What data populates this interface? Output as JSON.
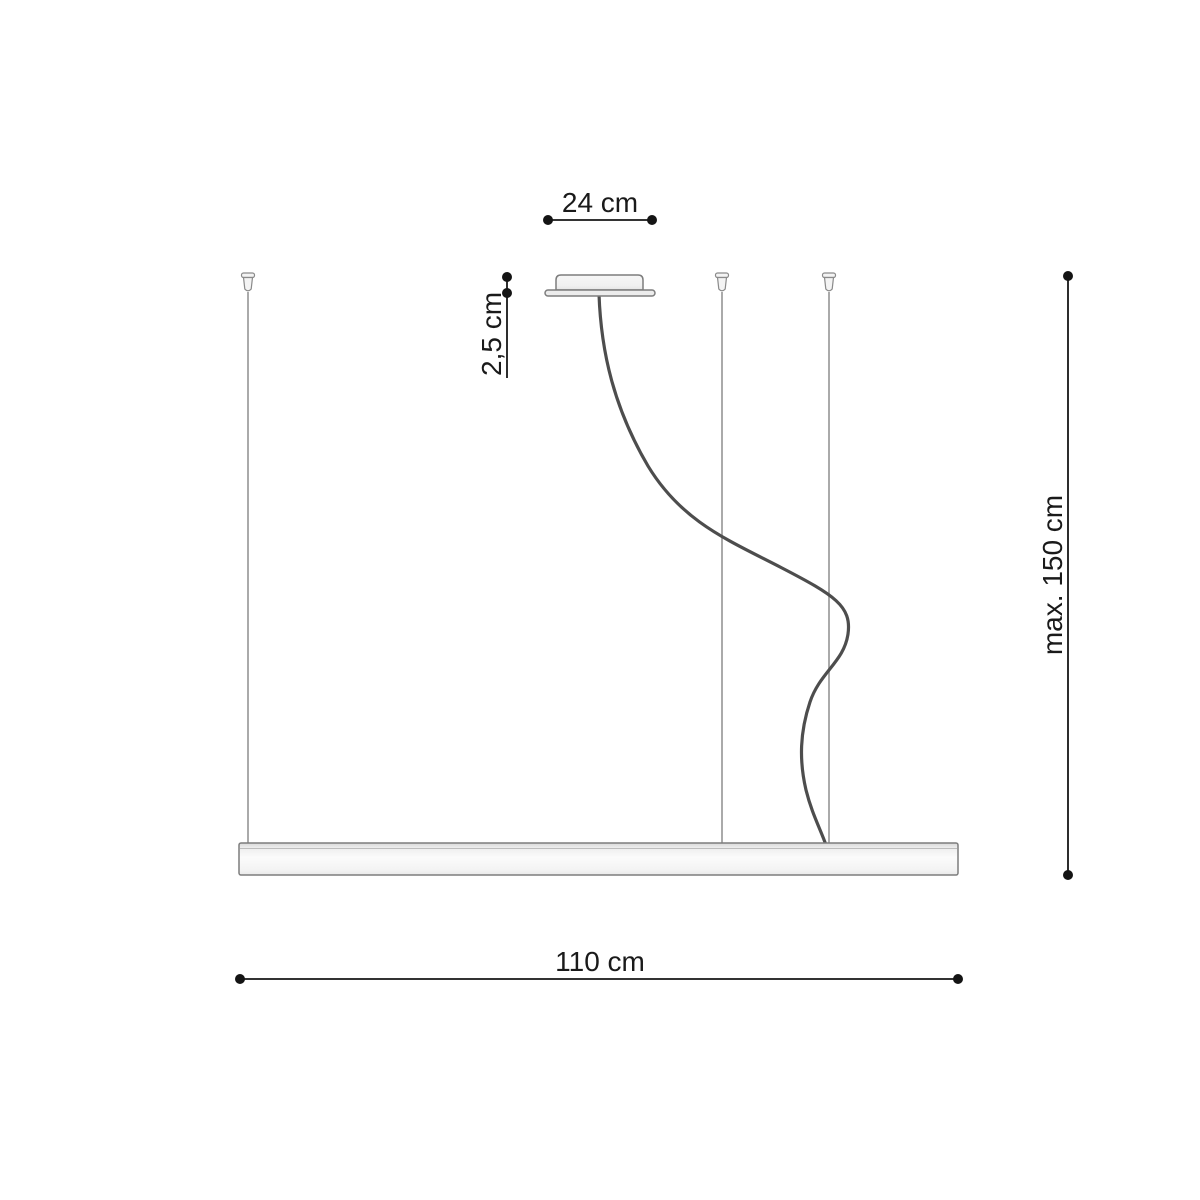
{
  "diagram": {
    "kind": "pendant-lamp-dimension-diagram",
    "dimensions": {
      "canopy_width": {
        "label": "24 cm"
      },
      "canopy_height": {
        "label": "2,5 cm"
      },
      "suspension_max": {
        "label": "max. 150 cm"
      },
      "bar_length": {
        "label": "110 cm"
      }
    },
    "colors": {
      "background": "#ffffff",
      "dimension_ink": "#161616",
      "wire": "#a0a0a0",
      "cable": "#4d4d4d",
      "fixture_outline": "#7d7d7d",
      "fixture_fill_light": "#fbfbfb",
      "fixture_fill_shade": "#e2e2e2"
    }
  }
}
